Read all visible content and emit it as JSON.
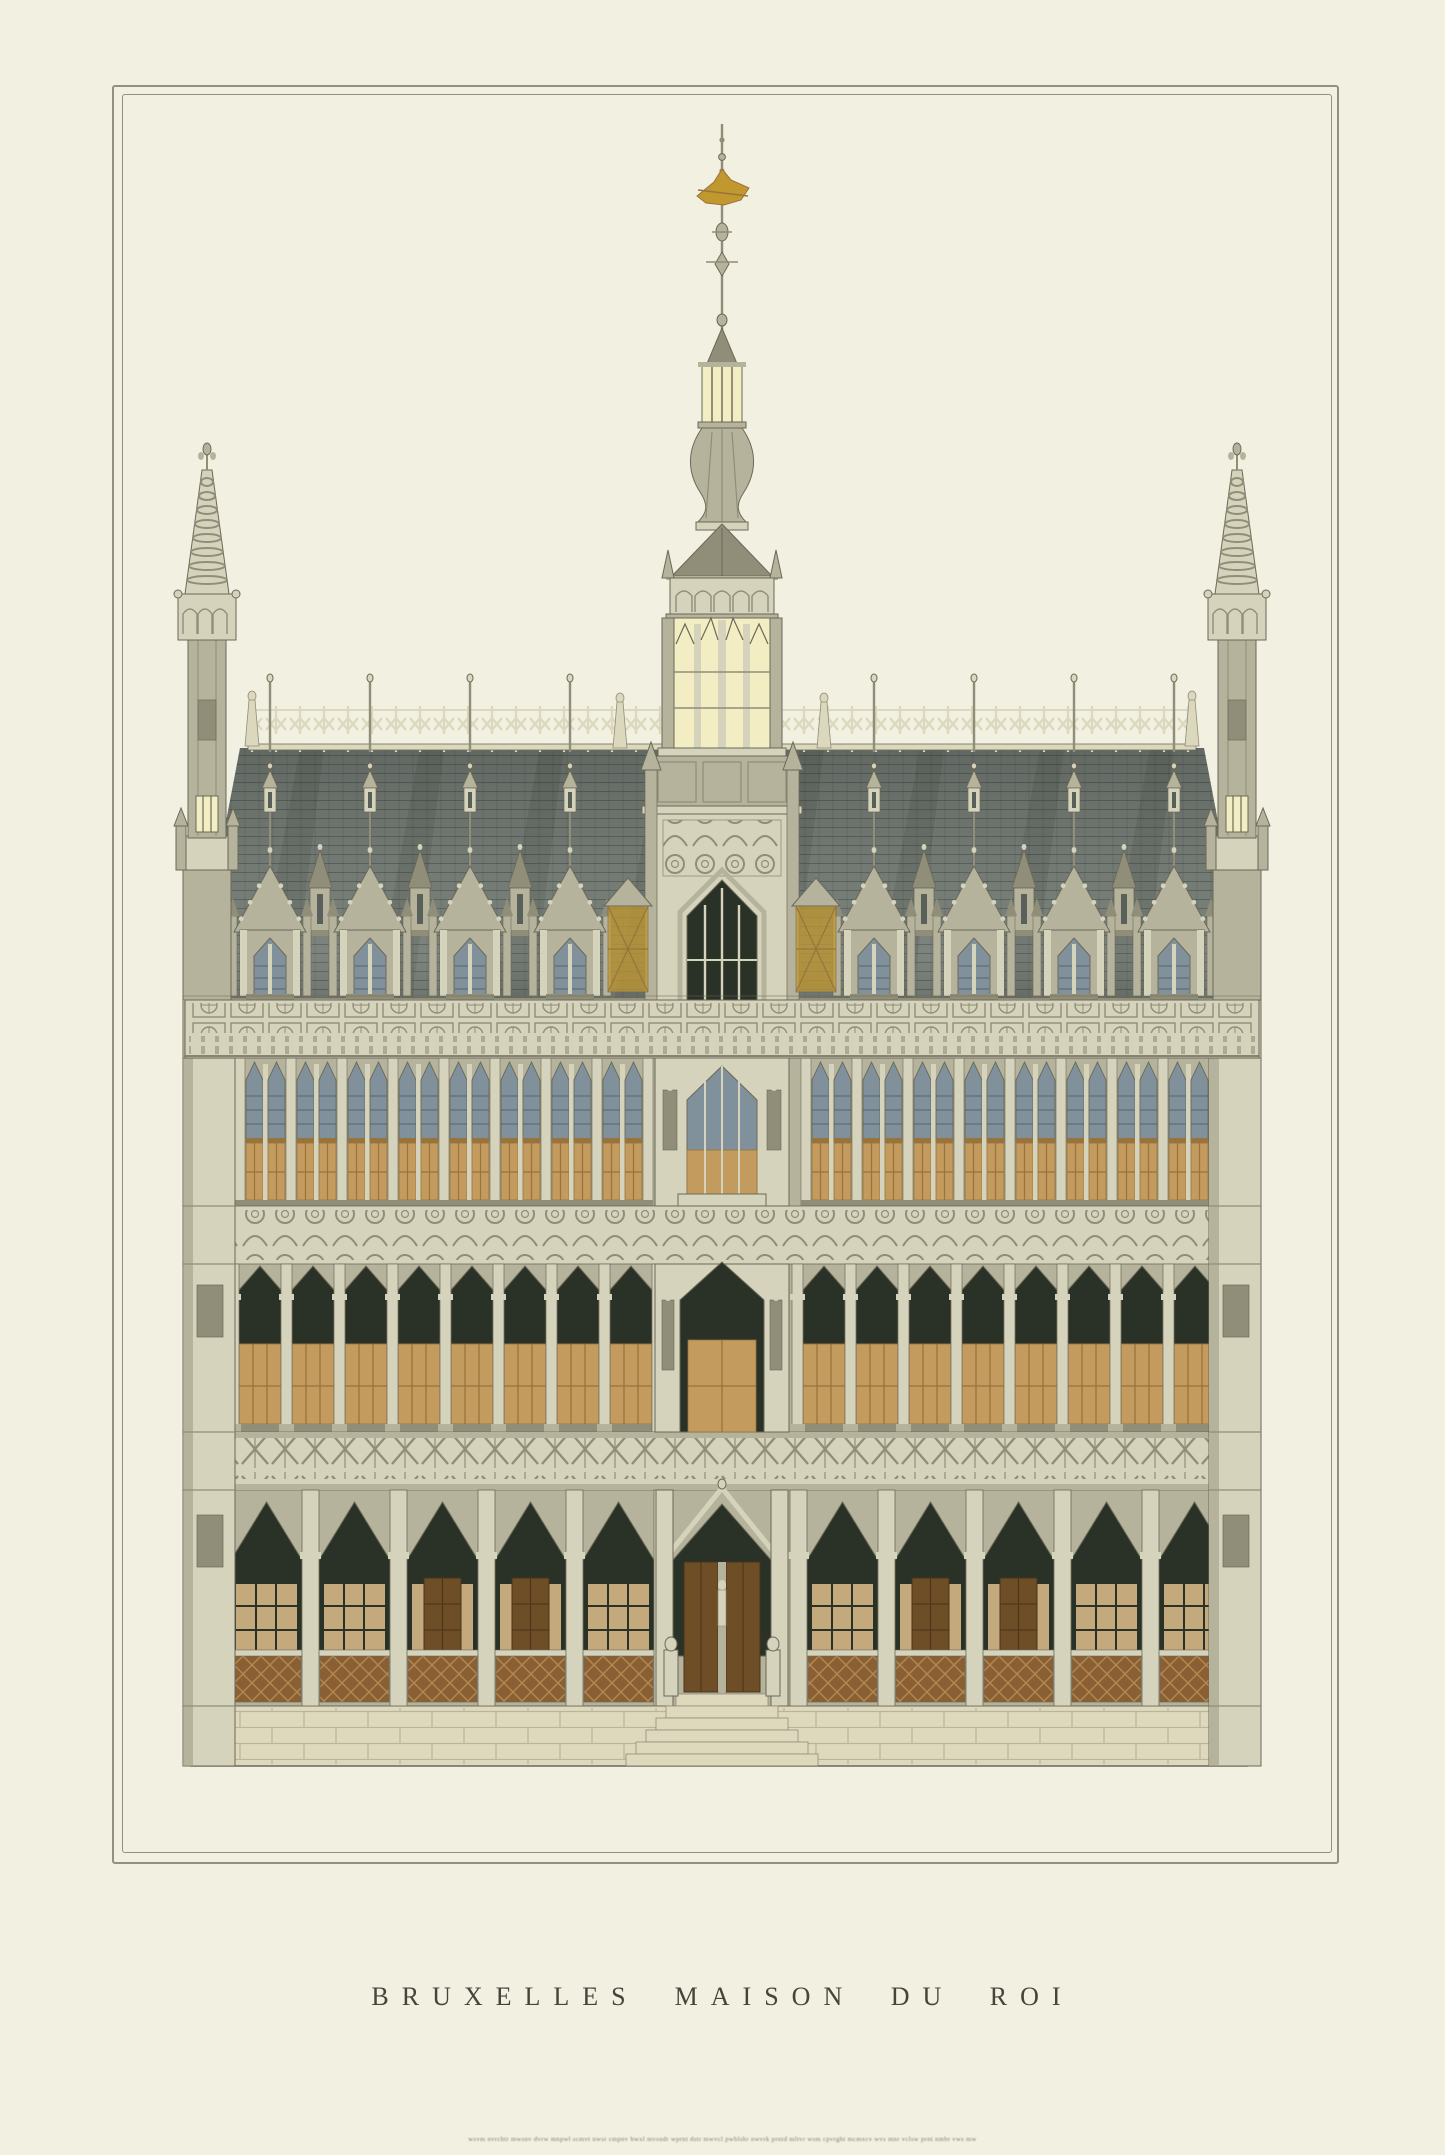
{
  "caption": {
    "city": "BRUXELLES",
    "building": "MAISON DU ROI"
  },
  "colophon": {
    "text": "wsvm nvrchtr mwsnv dvrw mnpwl scmvt nwsr cmpnv bwxl mvsndr wprnt dstr mwvcl pwblshr nwvrk prntd mltvr wsm cpvrght mcmxcv wvs mnr vclsw prnt nmbr vws mw"
  },
  "palette": {
    "paper": "#f1f0e1",
    "frame_line": "#8f927f",
    "stone_light": "#d6d3bd",
    "stone_mid": "#b6b39d",
    "stone_shadow": "#908d78",
    "stone_dark": "#6b6957",
    "cresting": "#dcd8bd",
    "roof": "#767d77",
    "roof_dark": "#596059",
    "roof_light": "#878e87",
    "glass_blue": "#81919c",
    "glass_blue_dark": "#566471",
    "amber": "#c39b5e",
    "amber_dark": "#99733c",
    "door_brown": "#6e4e27",
    "arch_interior": "#2a3126",
    "wall_tan": "#c3a97c",
    "rust": "#8a5f33",
    "pale_yellow": "#f3edc3",
    "gold": "#c0982e",
    "caption_text": "#45453b",
    "microtext": "#7a7a6c",
    "base_cream": "#ded9bd"
  }
}
